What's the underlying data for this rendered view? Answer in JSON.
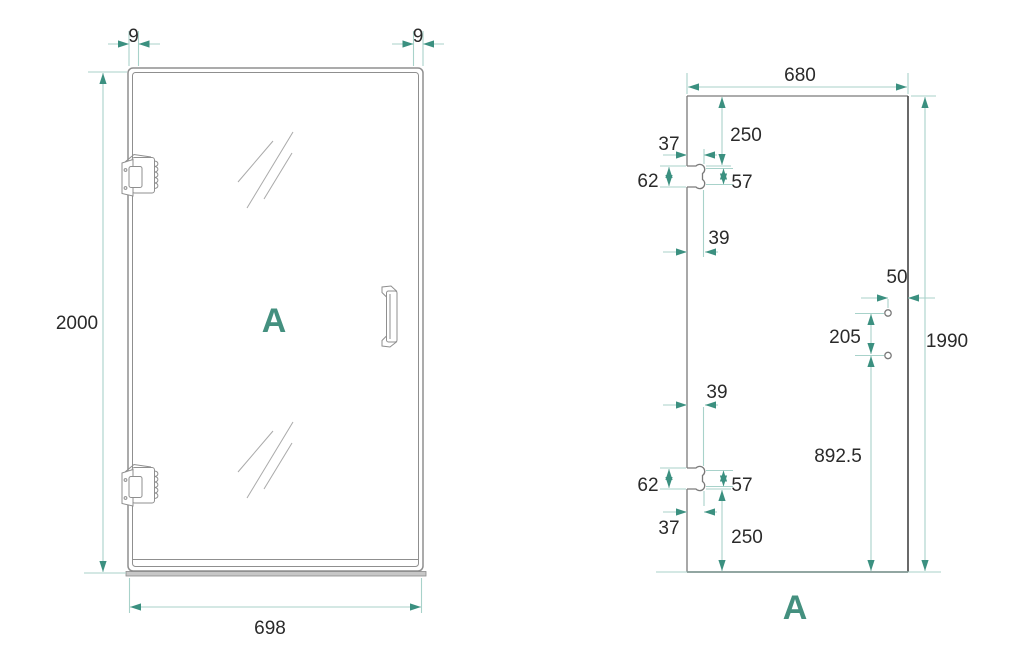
{
  "colors": {
    "accent_teal": "#3b9080",
    "dim_line_teal": "#a8d2ca",
    "outline_gray": "#8f8f8f",
    "edge_dark_gray": "#4f4f4f",
    "dim_text": "#2a2a2a"
  },
  "left_view": {
    "label": "A",
    "dims": {
      "frame_profile_left": "9",
      "frame_profile_right": "9",
      "door_height": "2000",
      "door_width": "698"
    }
  },
  "right_view": {
    "label": "A",
    "dims": {
      "glass_width": "680",
      "glass_height": "1990",
      "top_edge_to_cutout": "250",
      "top_cutout_inset": "37",
      "top_cutout_height": "62",
      "top_cutout_notch": "57",
      "top_cutout_width": "39",
      "hole_to_edge": "50",
      "hole_spacing": "205",
      "hole_to_bottom": "892.5",
      "bottom_cutout_width": "39",
      "bottom_cutout_height": "62",
      "bottom_cutout_notch": "57",
      "bottom_cutout_inset": "37",
      "bottom_edge_to_cutout": "250"
    }
  }
}
